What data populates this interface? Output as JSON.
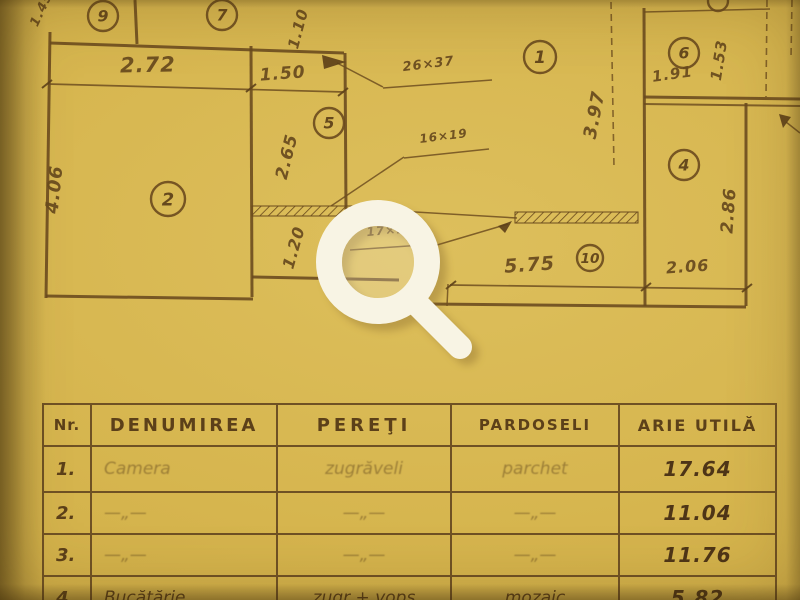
{
  "document": {
    "kind": "scanned apartment floor plan with room finish table"
  },
  "colors": {
    "paper": "#d6b54e",
    "ink": "#6a4a1e",
    "ink_dark": "#54391a",
    "faint_ink": "#9a7d3e",
    "lens_white": "#f8f4e4"
  },
  "plan": {
    "walls": [
      {
        "x1": 50,
        "y1": 32,
        "x2": 46,
        "y2": 298,
        "s": "wall"
      },
      {
        "x1": 50,
        "y1": 43,
        "x2": 344,
        "y2": 53,
        "s": "wall"
      },
      {
        "x1": 135,
        "y1": 0,
        "x2": 137,
        "y2": 44,
        "s": "wall"
      },
      {
        "x1": 251,
        "y1": 46,
        "x2": 252,
        "y2": 297,
        "s": "wall"
      },
      {
        "x1": 345,
        "y1": 53,
        "x2": 346,
        "y2": 210,
        "s": "wall"
      },
      {
        "x1": 46,
        "y1": 296,
        "x2": 253,
        "y2": 299,
        "s": "wall"
      },
      {
        "x1": 252,
        "y1": 277,
        "x2": 399,
        "y2": 280,
        "s": "wall"
      },
      {
        "x1": 430,
        "y1": 304,
        "x2": 746,
        "y2": 307,
        "s": "wall"
      },
      {
        "x1": 644,
        "y1": 8,
        "x2": 645,
        "y2": 306,
        "s": "wall"
      },
      {
        "x1": 746,
        "y1": 103,
        "x2": 746,
        "y2": 306,
        "s": "wall"
      },
      {
        "x1": 644,
        "y1": 97,
        "x2": 800,
        "y2": 99,
        "s": "wall"
      },
      {
        "x1": 644,
        "y1": 104,
        "x2": 800,
        "y2": 106,
        "s": "wall2"
      },
      {
        "x1": 644,
        "y1": 12,
        "x2": 770,
        "y2": 9,
        "s": "thin"
      },
      {
        "x1": 398,
        "y1": 211,
        "x2": 517,
        "y2": 218,
        "s": "thin"
      },
      {
        "x1": 786,
        "y1": 122,
        "x2": 800,
        "y2": 133,
        "s": "thin"
      },
      {
        "x1": 48,
        "y1": 84,
        "x2": 344,
        "y2": 92,
        "s": "dim"
      },
      {
        "x1": 450,
        "y1": 285,
        "x2": 746,
        "y2": 289,
        "s": "dim"
      },
      {
        "x1": 448,
        "y1": 284,
        "x2": 447,
        "y2": 306,
        "s": "thin"
      },
      {
        "x1": 383,
        "y1": 88,
        "x2": 492,
        "y2": 80,
        "s": "thin"
      },
      {
        "x1": 404,
        "y1": 158,
        "x2": 489,
        "y2": 149,
        "s": "thin"
      },
      {
        "x1": 350,
        "y1": 250,
        "x2": 437,
        "y2": 244,
        "s": "thin"
      },
      {
        "x1": 337,
        "y1": 63,
        "x2": 383,
        "y2": 87,
        "s": "thin"
      },
      {
        "x1": 404,
        "y1": 157,
        "x2": 331,
        "y2": 206,
        "s": "thin"
      },
      {
        "x1": 437,
        "y1": 245,
        "x2": 508,
        "y2": 224,
        "s": "thin"
      },
      {
        "x1": 611,
        "y1": 2,
        "x2": 614,
        "y2": 168,
        "s": "dash"
      },
      {
        "x1": 767,
        "y1": 0,
        "x2": 766,
        "y2": 97,
        "s": "dash"
      },
      {
        "x1": 792,
        "y1": 0,
        "x2": 791,
        "y2": 58,
        "s": "dash"
      },
      {
        "x1": 42,
        "y1": 88,
        "x2": 52,
        "y2": 80,
        "s": "tick"
      },
      {
        "x1": 246,
        "y1": 92,
        "x2": 256,
        "y2": 84,
        "s": "tick"
      },
      {
        "x1": 338,
        "y1": 96,
        "x2": 348,
        "y2": 88,
        "s": "tick"
      },
      {
        "x1": 446,
        "y1": 289,
        "x2": 456,
        "y2": 281,
        "s": "tick"
      },
      {
        "x1": 641,
        "y1": 291,
        "x2": 651,
        "y2": 283,
        "s": "tick"
      },
      {
        "x1": 742,
        "y1": 292,
        "x2": 752,
        "y2": 284,
        "s": "tick"
      }
    ],
    "hatches": [
      {
        "x": 252,
        "y": 206,
        "w": 146,
        "h": 10
      },
      {
        "x": 515,
        "y": 212,
        "w": 123,
        "h": 11
      }
    ],
    "arrows": [
      "322,55 346,62 324,69",
      "512,221 498,226 505,233",
      "779,114 791,117 783,128"
    ],
    "partial_circle": {
      "x": 718,
      "y": 1,
      "r": 10
    },
    "rooms": [
      {
        "n": "9",
        "x": 103,
        "y": 16,
        "r": 15
      },
      {
        "n": "7",
        "x": 222,
        "y": 15,
        "r": 15
      },
      {
        "n": "1",
        "x": 540,
        "y": 57,
        "r": 16
      },
      {
        "n": "6",
        "x": 684,
        "y": 53,
        "r": 15
      },
      {
        "n": "5",
        "x": 329,
        "y": 123,
        "r": 15
      },
      {
        "n": "4",
        "x": 684,
        "y": 165,
        "r": 15
      },
      {
        "n": "2",
        "x": 168,
        "y": 199,
        "r": 17
      },
      {
        "n": "10",
        "x": 590,
        "y": 258,
        "r": 13
      }
    ],
    "dimensions": [
      {
        "t": "2.72",
        "x": 148,
        "y": 72,
        "r": -1,
        "s": 21
      },
      {
        "t": "1.50",
        "x": 283,
        "y": 79,
        "r": -4,
        "s": 17
      },
      {
        "t": "1.10",
        "x": 303,
        "y": 30,
        "r": -75,
        "s": 15
      },
      {
        "t": "1.45",
        "x": 45,
        "y": 11,
        "r": -65,
        "s": 13
      },
      {
        "t": "4.06",
        "x": 60,
        "y": 190,
        "r": -84,
        "s": 18
      },
      {
        "t": "2.65",
        "x": 292,
        "y": 158,
        "r": -76,
        "s": 17
      },
      {
        "t": "1.20",
        "x": 299,
        "y": 249,
        "r": -74,
        "s": 16
      },
      {
        "t": "3.97",
        "x": 600,
        "y": 116,
        "r": -79,
        "s": 18
      },
      {
        "t": "1.91",
        "x": 673,
        "y": 79,
        "r": -8,
        "s": 15
      },
      {
        "t": "1.53",
        "x": 724,
        "y": 61,
        "r": -81,
        "s": 15
      },
      {
        "t": "2.86",
        "x": 734,
        "y": 211,
        "r": -86,
        "s": 17
      },
      {
        "t": "5.75",
        "x": 530,
        "y": 271,
        "r": -4,
        "s": 19
      },
      {
        "t": "2.06",
        "x": 688,
        "y": 272,
        "r": -4,
        "s": 16
      },
      {
        "t": "26×37",
        "x": 429,
        "y": 68,
        "r": -7,
        "s": 13
      },
      {
        "t": "16×19",
        "x": 444,
        "y": 140,
        "r": -7,
        "s": 12
      },
      {
        "t": "17×19",
        "x": 391,
        "y": 234,
        "r": -5,
        "s": 12
      }
    ]
  },
  "magnifier": {
    "label": "zoom magnifier"
  },
  "table": {
    "headers": [
      "Nr.",
      "DENUMIREA",
      "PEREŢI",
      "PARDOSELI",
      "ARIE UTILĂ"
    ],
    "rows": [
      {
        "nr": "1.",
        "denumirea": "Camera",
        "pereti": "zugrăveli",
        "pardoseli": "parchet",
        "arie": "17.64",
        "faint": true
      },
      {
        "nr": "2.",
        "denumirea": "—„—",
        "pereti": "—„—",
        "pardoseli": "—„—",
        "arie": "11.04",
        "faint": true
      },
      {
        "nr": "3.",
        "denumirea": "—„—",
        "pereti": "—„—",
        "pardoseli": "—„—",
        "arie": "11.76",
        "faint": true
      },
      {
        "nr": "4.",
        "denumirea": "Bucătărie",
        "pereti": "zugr + vops",
        "pardoseli": "mozaic",
        "arie": "5.82",
        "faint": false
      }
    ]
  }
}
